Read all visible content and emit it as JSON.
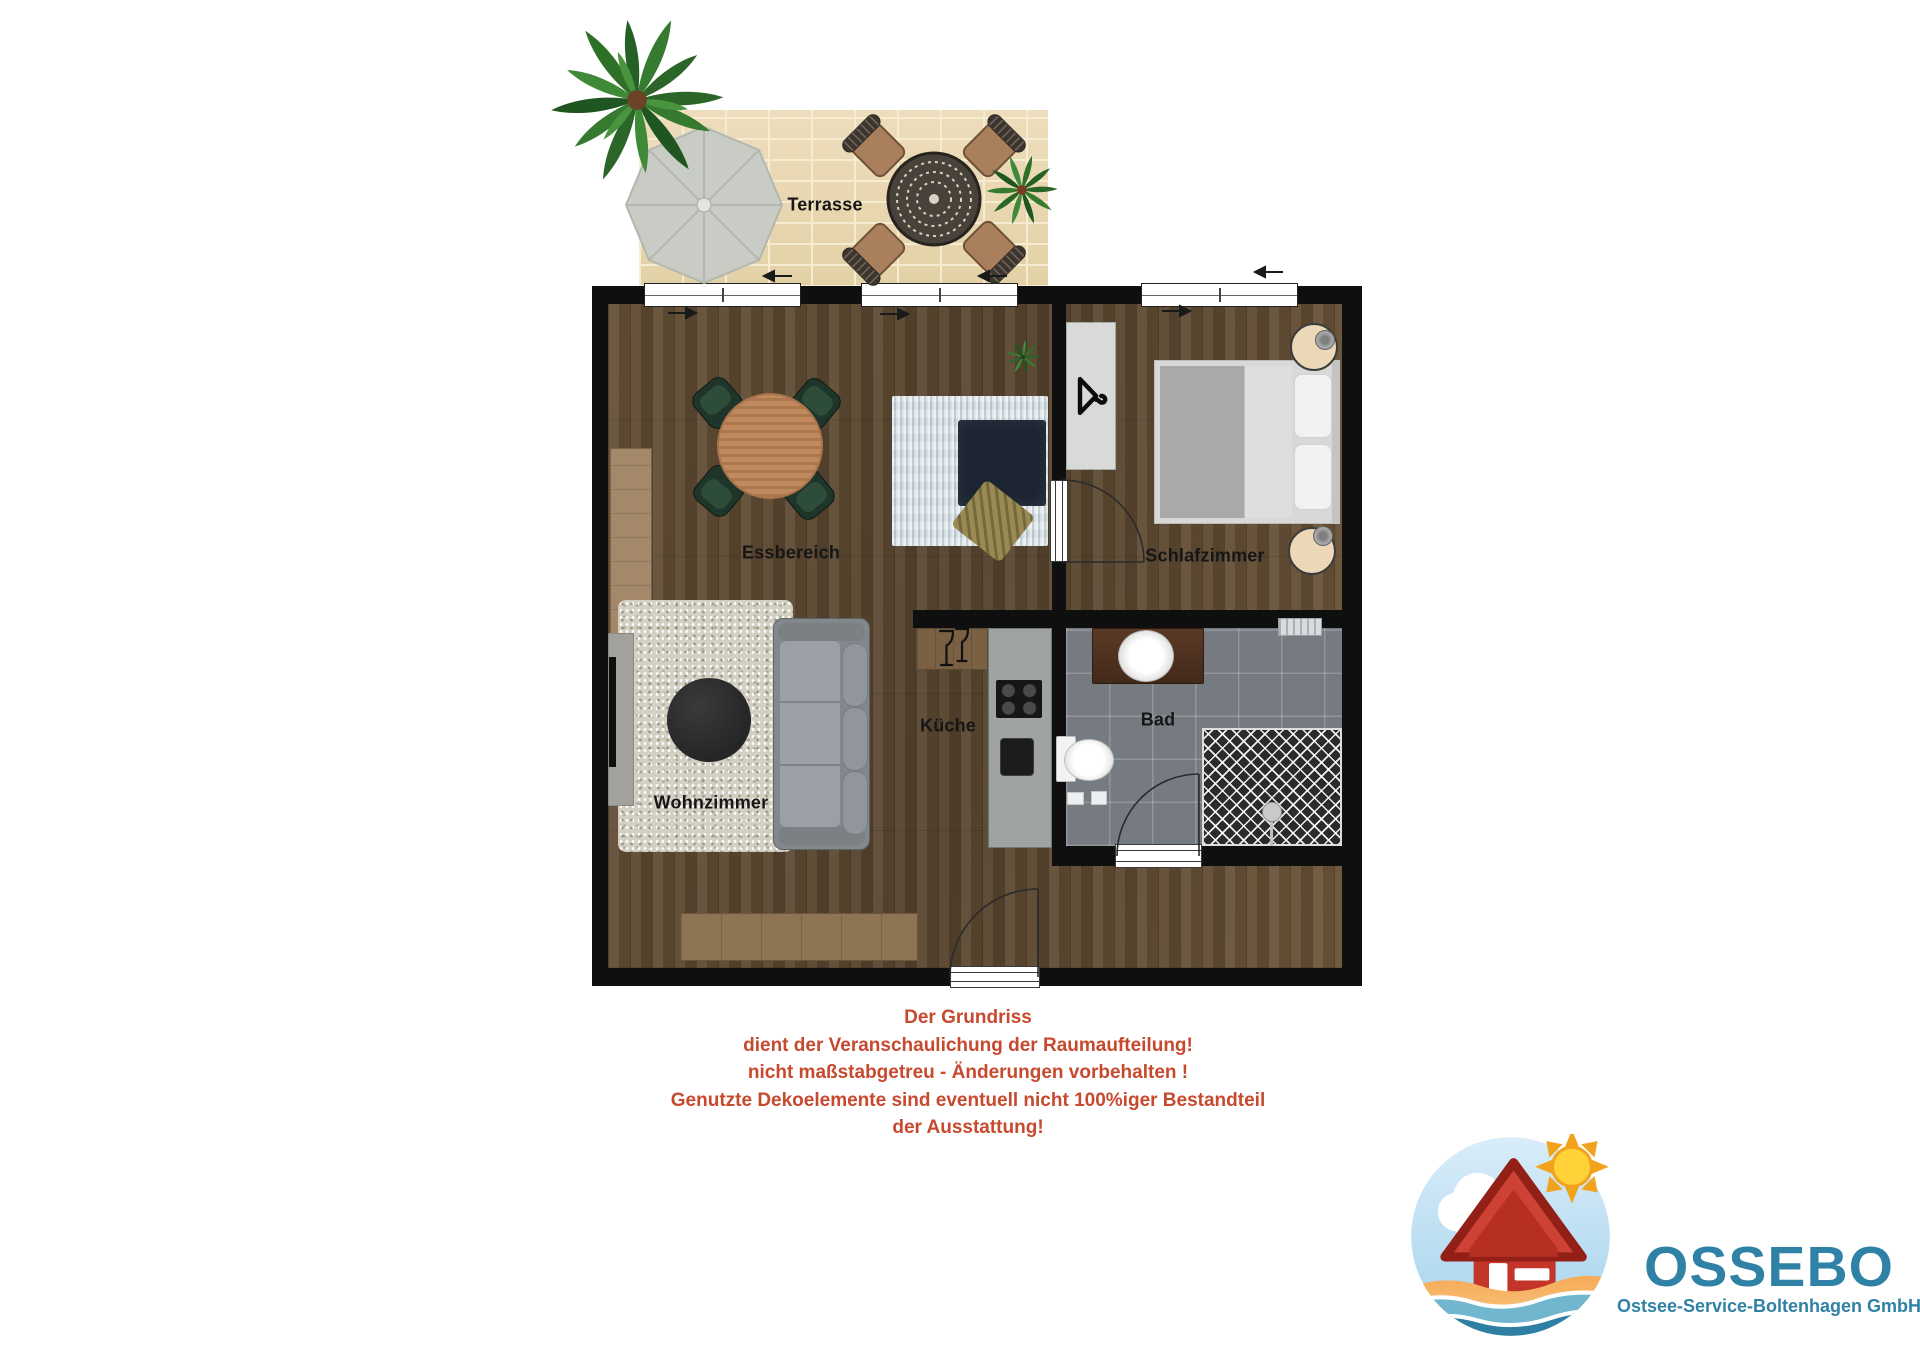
{
  "page": {
    "type": "apartment-floor-plan",
    "background": "#ffffff"
  },
  "terrace": {
    "label": "Terrasse"
  },
  "rooms": [
    {
      "id": "essbereich",
      "label": "Essbereich"
    },
    {
      "id": "schlafzimmer",
      "label": "Schlafzimmer"
    },
    {
      "id": "kueche",
      "label": "Küche"
    },
    {
      "id": "bad",
      "label": "Bad"
    },
    {
      "id": "wohnzimmer",
      "label": "Wohnzimmer"
    }
  ],
  "disclaimer": {
    "color": "#c7492e",
    "lines": [
      "Der Grundriss",
      "dient der Veranschaulichung der Raumaufteilung!",
      "nicht maßstabgetreu - Änderungen vorbehalten !",
      "Genutzte Dekoelemente sind eventuell nicht 100%iger Bestandteil",
      "der Ausstattung!"
    ]
  },
  "logo": {
    "wordmark": "OSSEBO",
    "subtitle": "Ostsee-Service-Boltenhagen GmbH",
    "text_color": "#2f81a5"
  },
  "colors": {
    "wall": "#0f0f0f",
    "wood_floor": "#6a543a",
    "terrace_paving": "#ead9b5",
    "bath_tile": "#767b81",
    "shower_tile": "#2b2b2b",
    "label_text": "#161616",
    "disclaimer_red": "#c7492e",
    "logo_blue": "#2f81a5"
  },
  "icons": {
    "palm": "palm-plant-icon",
    "umbrella": "patio-umbrella-icon",
    "patio_table": "patio-table-icon",
    "hanger": "clothes-hanger-icon",
    "glasses": "wine-glasses-icon",
    "shower_head": "shower-head-icon",
    "sun": "sun-icon",
    "cloud": "cloud-icon",
    "house": "beach-house-icon",
    "waves": "waves-icon",
    "window_arrow": "window-arrow-icon"
  }
}
